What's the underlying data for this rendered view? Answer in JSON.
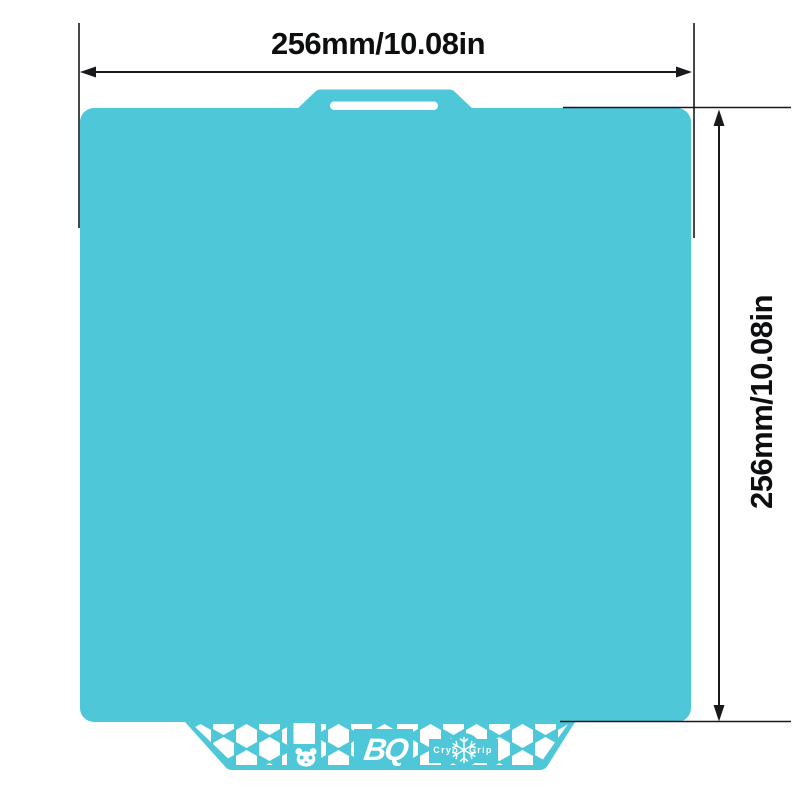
{
  "page": {
    "background": "#ffffff"
  },
  "dimensions": {
    "width_label": "256mm/10.08in",
    "height_label": "256mm/10.08in"
  },
  "plate": {
    "color": "#4ec7d9",
    "logo_text": "BQ",
    "brand_left": "Cryo",
    "brand_right": "Grip"
  },
  "icons": {
    "panda": "panda-face-cutout",
    "snowflake": "❄"
  },
  "annotation": {
    "line_color": "#17191c",
    "text_color": "#0d0e10"
  }
}
